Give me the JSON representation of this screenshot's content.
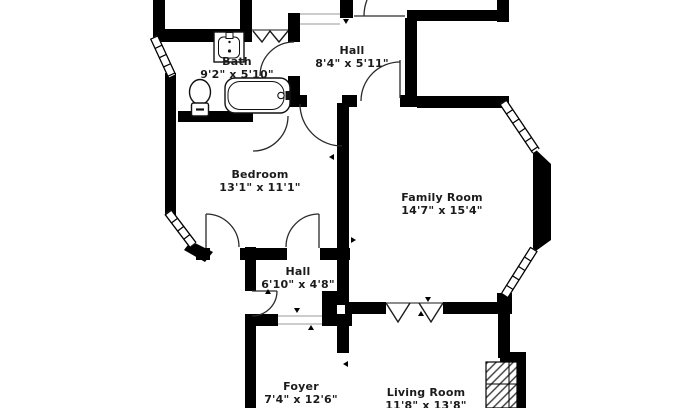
{
  "title": "Residential floor plan",
  "colors": {
    "background": "#ffffff",
    "wall": "#000000",
    "door_line": "#2a2a2a",
    "text": "#1b1b1b"
  },
  "rooms": [
    {
      "name": "Bath",
      "dims": "9'2\" x 5'10\""
    },
    {
      "name": "Hall",
      "dims": "8'4\" x 5'11\""
    },
    {
      "name": "Bedroom",
      "dims": "13'1\" x 11'1\""
    },
    {
      "name": "Family Room",
      "dims": "14'7\" x 15'4\""
    },
    {
      "name": "Hall",
      "dims": "6'10\" x 4'8\""
    },
    {
      "name": "Foyer",
      "dims": "7'4\" x 12'6\""
    },
    {
      "name": "Living Room",
      "dims": "11'8\" x 13'8\""
    }
  ],
  "fixtures": [
    {
      "name": "sink"
    },
    {
      "name": "toilet"
    },
    {
      "name": "bathtub"
    },
    {
      "name": "fireplace"
    }
  ],
  "symbols": [
    {
      "name": "door-swing-arc"
    },
    {
      "name": "bifold-door-zigzag"
    },
    {
      "name": "window-hatch"
    },
    {
      "name": "dimension-tick"
    }
  ]
}
